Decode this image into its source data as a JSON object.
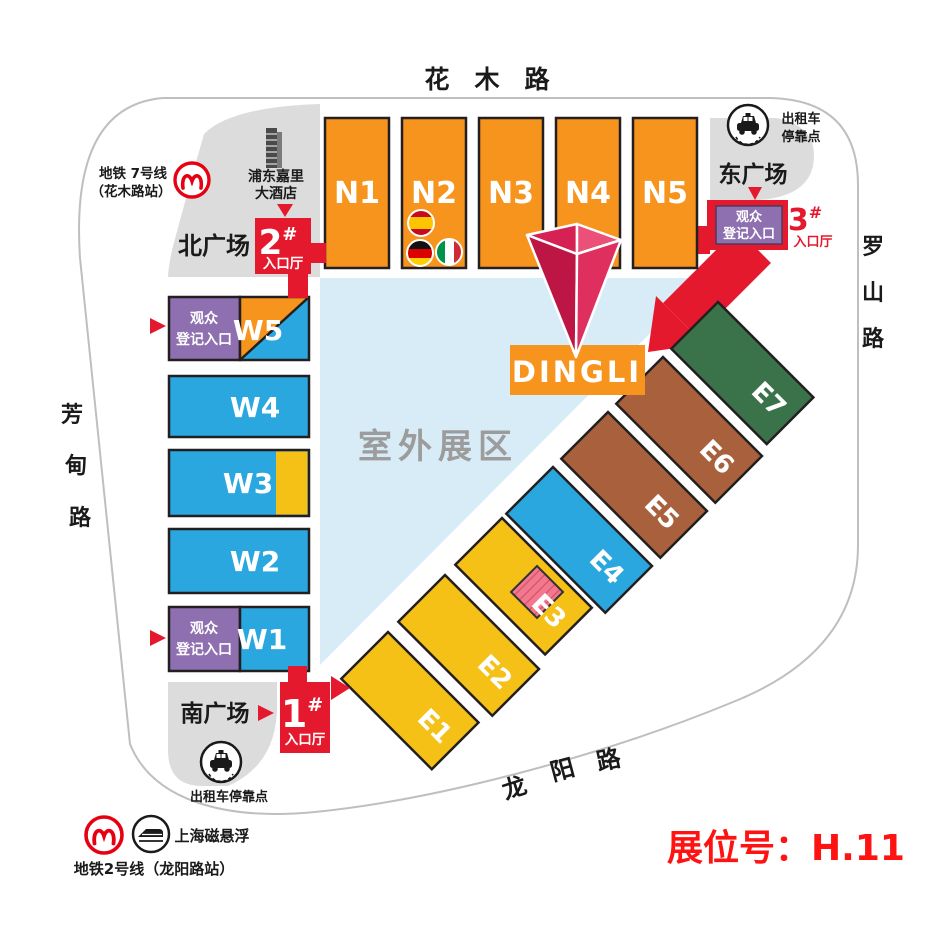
{
  "roads": {
    "top": "花　木　路",
    "left": [
      "芳",
      "甸",
      "路"
    ],
    "right": [
      "罗",
      "山",
      "路"
    ],
    "bottom": [
      "龙",
      "阳",
      "路"
    ]
  },
  "plazas": {
    "north": "北广场",
    "east": "东广场",
    "south": "南广场"
  },
  "halls": {
    "north": [
      "N1",
      "N2",
      "N3",
      "N4",
      "N5"
    ],
    "west": [
      "W5",
      "W4",
      "W3",
      "W2",
      "W1"
    ],
    "east": [
      "E1",
      "E2",
      "E3",
      "E4",
      "E5",
      "E6",
      "E7"
    ]
  },
  "entrances": {
    "e1": {
      "num": "1",
      "hash": "#",
      "hall_label": "入口厅"
    },
    "e2": {
      "num": "2",
      "hash": "#",
      "hall_label": "入口厅"
    },
    "e3": {
      "num": "3",
      "hash": "#",
      "hall_label": "入口厅"
    }
  },
  "registration": {
    "line1": "观众",
    "line2": "登记入口"
  },
  "transit": {
    "metro7": {
      "line1": "地铁 7号线",
      "line2": "（花木路站）"
    },
    "metro2": "地铁2号线（龙阳路站）",
    "maglev": "上海磁悬浮",
    "hotel": {
      "line1": "浦东嘉里",
      "line2": "大酒店"
    },
    "taxi_east": {
      "line1": "出租车",
      "line2": "停靠点"
    },
    "taxi_south": "出租车停靠点"
  },
  "outdoor": "室外展区",
  "brand": "DINGLI",
  "booth": {
    "label": "展位号：",
    "value": "H.11"
  },
  "flags": [
    "spain-flag",
    "germany-flag",
    "italy-flag"
  ],
  "colors": {
    "orange": "#F6941D",
    "blue": "#2BA7DF",
    "yellow": "#F5C116",
    "green": "#3A7249",
    "brown": "#A8613C",
    "purple": "#8E6FB0",
    "entrance_red": "#E5192D",
    "pin_crimson": "#D62154",
    "outdoor_blue": "#D8ECF7",
    "plaza_gray": "#DCDCDC",
    "highlight_pink": "#F2788E",
    "booth_text_red": "#FF1212",
    "metro_red": "#E60012"
  }
}
